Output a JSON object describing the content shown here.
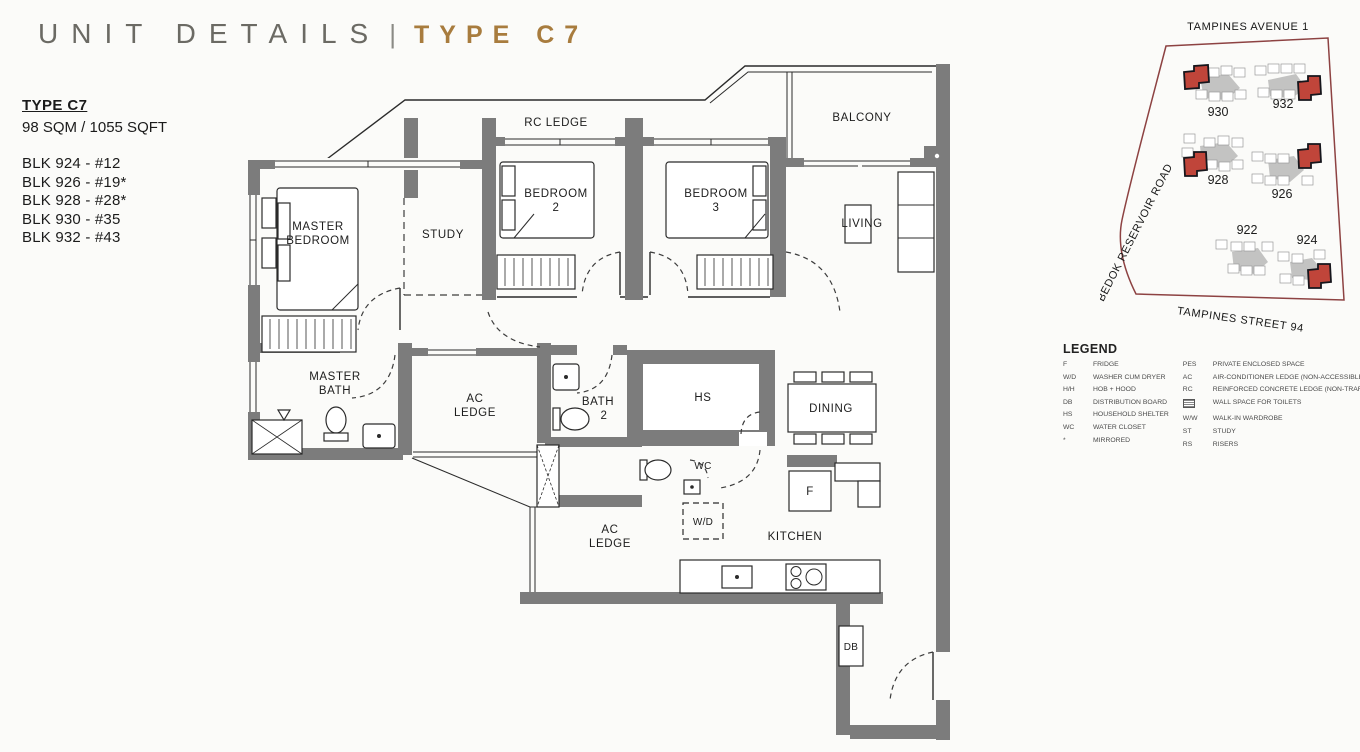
{
  "header": {
    "title": "UNIT DETAILS",
    "separator": "|",
    "type": "TYPE C7"
  },
  "unit_info": {
    "type_label": "TYPE C7",
    "area": "98 SQM / 1055 SQFT",
    "blocks": [
      "BLK 924 - #12",
      "BLK 926 - #19*",
      "BLK 928 - #28*",
      "BLK 930 - #35",
      "BLK 932 - #43"
    ]
  },
  "floor_plan": {
    "rooms": {
      "rc_ledge": [
        "RC LEDGE"
      ],
      "balcony": [
        "BALCONY"
      ],
      "master_bedroom": [
        "MASTER",
        "BEDROOM"
      ],
      "study": [
        "STUDY"
      ],
      "bedroom2": [
        "BEDROOM",
        "2"
      ],
      "bedroom3": [
        "BEDROOM",
        "3"
      ],
      "living": [
        "LIVING"
      ],
      "master_bath": [
        "MASTER",
        "BATH"
      ],
      "ac_ledge_upper": [
        "AC",
        "LEDGE"
      ],
      "bath2": [
        "BATH",
        "2"
      ],
      "hs": [
        "HS"
      ],
      "dining": [
        "DINING"
      ],
      "wc": [
        "WC"
      ],
      "ac_ledge_lower": [
        "AC",
        "LEDGE"
      ],
      "wd": [
        "W/D"
      ],
      "kitchen": [
        "KITCHEN"
      ],
      "fridge": [
        "F"
      ],
      "db": [
        "DB"
      ]
    }
  },
  "site_map": {
    "roads": {
      "top": "TAMPINES AVENUE 1",
      "left": "BEDOK RESERVOIR ROAD",
      "bottom": "TAMPINES STREET 94"
    },
    "blocks": [
      "930",
      "932",
      "928",
      "926",
      "922",
      "924"
    ]
  },
  "legend": {
    "title": "LEGEND",
    "left": [
      {
        "abbr": "F",
        "label": "FRIDGE"
      },
      {
        "abbr": "W/D",
        "label": "WASHER CUM DRYER"
      },
      {
        "abbr": "H/H",
        "label": "HOB + HOOD"
      },
      {
        "abbr": "DB",
        "label": "DISTRIBUTION BOARD"
      },
      {
        "abbr": "HS",
        "label": "HOUSEHOLD SHELTER"
      },
      {
        "abbr": "WC",
        "label": "WATER CLOSET"
      },
      {
        "abbr": "*",
        "label": "MIRRORED"
      }
    ],
    "right": [
      {
        "abbr": "PES",
        "label": "PRIVATE ENCLOSED SPACE"
      },
      {
        "abbr": "AC",
        "label": "AIR-CONDITIONER LEDGE (NON-ACCESSIBLE)"
      },
      {
        "abbr": "RC",
        "label": "REINFORCED CONCRETE LEDGE (NON-TRAFFICABLE)"
      },
      {
        "abbr": "",
        "label": "WALL SPACE FOR TOILETS"
      },
      {
        "abbr": "W/W",
        "label": "WALK-IN WARDROBE"
      },
      {
        "abbr": "ST",
        "label": "STUDY"
      },
      {
        "abbr": "RS",
        "label": "RISERS"
      }
    ]
  },
  "colors": {
    "accent_gold": "#A87C3E",
    "title_gray": "#6B6A64",
    "wall_gray": "#7C7C7C",
    "boundary_red": "#8D4242",
    "unit_red": "#C0453A"
  }
}
